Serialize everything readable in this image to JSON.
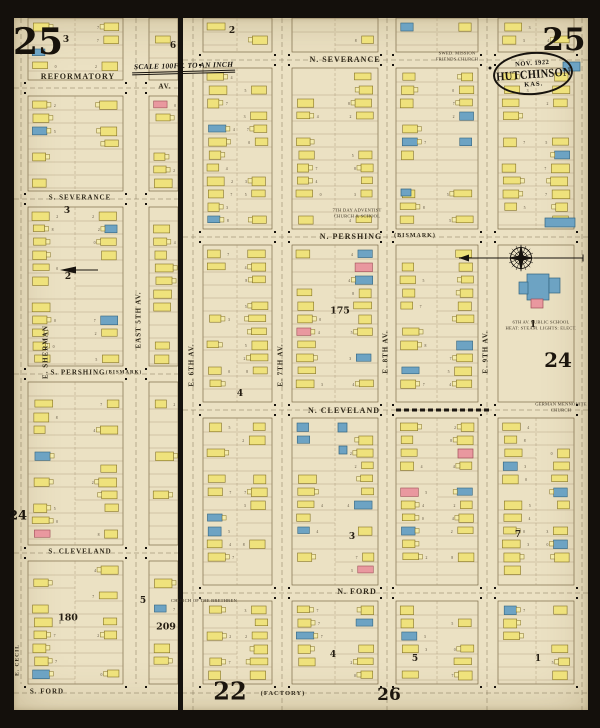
{
  "sheet": {
    "title": "Sanborn Insurance Map - Hutchinson, Kansas - Sheet 25",
    "number_top_left": "25",
    "number_top_right": "25",
    "stamp": {
      "date": "NOV. 1922",
      "city": "HUTCHINSON",
      "state": "KAS."
    },
    "scale_banner": "SCALE 100FT. TO AN INCH",
    "lot_number_glyphs": "2345780"
  },
  "colors": {
    "paper": "#ebe1c3",
    "ink": "#17130e",
    "block-line": "#7c6b48",
    "lot-line": "#a39170",
    "bldg-yellow": "#efe27c",
    "bldg-yellow-stroke": "#857326",
    "bldg-blue": "#6da3c3",
    "bldg-blue-stroke": "#33647f",
    "bldg-pink": "#e9989f",
    "bldg-pink-stroke": "#9e4f58"
  },
  "street_labels": [
    {
      "text": "REFORMATORY",
      "x": 78,
      "y": 77,
      "fs": 8
    },
    {
      "text": "AV.",
      "x": 165,
      "y": 87,
      "fs": 7
    },
    {
      "text": "N. SEVERANCE",
      "x": 345,
      "y": 60,
      "fs": 8
    },
    {
      "text": "S. SEVERANCE",
      "x": 80,
      "y": 198,
      "fs": 7
    },
    {
      "text": "N. PERSHING",
      "x": 351,
      "y": 237,
      "fs": 8
    },
    {
      "text": "(BISMARK)",
      "x": 415,
      "y": 236,
      "fs": 6
    },
    {
      "text": "S. PERSHING",
      "x": 78,
      "y": 373,
      "fs": 7
    },
    {
      "text": "(BISMARK)",
      "x": 124,
      "y": 373,
      "fs": 5
    },
    {
      "text": "N. CLEVELAND",
      "x": 344,
      "y": 411,
      "fs": 8
    },
    {
      "text": "S. CLEVELAND",
      "x": 80,
      "y": 552,
      "fs": 7
    },
    {
      "text": "N. FORD",
      "x": 357,
      "y": 592,
      "fs": 8
    },
    {
      "text": "S. FORD",
      "x": 47,
      "y": 692,
      "fs": 7
    },
    {
      "text": "(FACTORY)",
      "x": 283,
      "y": 694,
      "fs": 6.5
    },
    {
      "text": "E. SHERMAN",
      "x": 46,
      "y": 352,
      "fs": 7,
      "v": true
    },
    {
      "text": "EAST 5TH AV.",
      "x": 139,
      "y": 320,
      "fs": 7,
      "v": true
    },
    {
      "text": "E. 6TH AV.",
      "x": 192,
      "y": 365,
      "fs": 7,
      "v": true
    },
    {
      "text": "E. 7TH AV.",
      "x": 281,
      "y": 365,
      "fs": 7,
      "v": true
    },
    {
      "text": "E. 8TH AV.",
      "x": 386,
      "y": 352,
      "fs": 7,
      "v": true
    },
    {
      "text": "E. 9TH AV.",
      "x": 486,
      "y": 352,
      "fs": 7,
      "v": true
    },
    {
      "text": "E. CECIL",
      "x": 18,
      "y": 660,
      "fs": 5.5,
      "v": true
    }
  ],
  "adjacent_sheet_refs": [
    {
      "t": "24",
      "x": 558,
      "y": 360,
      "fs": 20
    },
    {
      "t": "24",
      "x": 18,
      "y": 516,
      "fs": 13
    },
    {
      "t": "22",
      "x": 230,
      "y": 691,
      "fs": 24
    },
    {
      "t": "26",
      "x": 389,
      "y": 695,
      "fs": 17
    }
  ],
  "block_numbers": [
    {
      "t": "3",
      "x": 66,
      "y": 40
    },
    {
      "t": "6",
      "x": 173,
      "y": 46
    },
    {
      "t": "2",
      "x": 232,
      "y": 31
    },
    {
      "t": "3",
      "x": 67,
      "y": 211
    },
    {
      "t": "2",
      "x": 68,
      "y": 277
    },
    {
      "t": "175",
      "x": 340,
      "y": 311
    },
    {
      "t": "1",
      "x": 533,
      "y": 325
    },
    {
      "t": "4",
      "x": 240,
      "y": 394
    },
    {
      "t": "3",
      "x": 352,
      "y": 537
    },
    {
      "t": "7",
      "x": 518,
      "y": 535
    },
    {
      "t": "180",
      "x": 68,
      "y": 618
    },
    {
      "t": "209",
      "x": 166,
      "y": 627
    },
    {
      "t": "5",
      "x": 143,
      "y": 601
    },
    {
      "t": "4",
      "x": 333,
      "y": 655
    },
    {
      "t": "5",
      "x": 415,
      "y": 659
    },
    {
      "t": "1",
      "x": 538,
      "y": 659
    }
  ],
  "landmarks": [
    {
      "lines": [
        "SWED. MISSION",
        "FRIENDS CHURCH"
      ],
      "x": 457,
      "y": 56
    },
    {
      "lines": [
        "7TH DAY ADVENTIST",
        "CHURCH & SCHOOL"
      ],
      "x": 357,
      "y": 213
    },
    {
      "lines": [
        "6TH AV. PUBLIC SCHOOL",
        "HEAT: STEAM. LIGHTS: ELECT."
      ],
      "x": 541,
      "y": 325
    },
    {
      "lines": [
        "CHURCH OF THE BRETHREN"
      ],
      "x": 204,
      "y": 601
    },
    {
      "lines": [
        "GERMAN MENNONITE",
        "CHURCH"
      ],
      "x": 561,
      "y": 407
    }
  ],
  "map": {
    "corridors_h": [
      {
        "y": 88,
        "x1": 14,
        "x2": 178
      },
      {
        "y": 60,
        "x1": 183,
        "x2": 588
      },
      {
        "y": 199,
        "x1": 14,
        "x2": 178
      },
      {
        "y": 237,
        "x1": 183,
        "x2": 588
      },
      {
        "y": 374,
        "x1": 14,
        "x2": 178
      },
      {
        "y": 410,
        "x1": 183,
        "x2": 588
      },
      {
        "y": 553,
        "x1": 14,
        "x2": 178
      },
      {
        "y": 593,
        "x1": 183,
        "x2": 588
      },
      {
        "y": 693,
        "x1": 14,
        "x2": 588
      }
    ],
    "corridors_v": [
      {
        "x": 21,
        "y1": 18,
        "y2": 684
      },
      {
        "x": 136,
        "y1": 18,
        "y2": 684
      },
      {
        "x": 193,
        "y1": 18,
        "y2": 710
      },
      {
        "x": 282,
        "y1": 18,
        "y2": 710
      },
      {
        "x": 387,
        "y1": 18,
        "y2": 710
      },
      {
        "x": 487,
        "y1": 18,
        "y2": 710
      },
      {
        "x": 582,
        "y1": 18,
        "y2": 710
      }
    ],
    "blocks": [
      {
        "x1": 28,
        "y1": 18,
        "x2": 123,
        "y2": 80,
        "alley": 75
      },
      {
        "x1": 28,
        "y1": 96,
        "x2": 123,
        "y2": 191,
        "alley": 75
      },
      {
        "x1": 28,
        "y1": 207,
        "x2": 123,
        "y2": 366,
        "alley": 75
      },
      {
        "x1": 28,
        "y1": 382,
        "x2": 123,
        "y2": 545,
        "alley": 75
      },
      {
        "x1": 28,
        "y1": 561,
        "x2": 123,
        "y2": 684,
        "alley": 75
      },
      {
        "x1": 149,
        "y1": 18,
        "x2": 178,
        "y2": 80
      },
      {
        "x1": 149,
        "y1": 96,
        "x2": 178,
        "y2": 191
      },
      {
        "x1": 149,
        "y1": 207,
        "x2": 178,
        "y2": 366
      },
      {
        "x1": 149,
        "y1": 382,
        "x2": 178,
        "y2": 545,
        "density": 0.2
      },
      {
        "x1": 149,
        "y1": 561,
        "x2": 178,
        "y2": 684
      },
      {
        "x1": 203,
        "y1": 18,
        "x2": 272,
        "y2": 52,
        "alley": 237
      },
      {
        "x1": 203,
        "y1": 68,
        "x2": 272,
        "y2": 229,
        "alley": 237
      },
      {
        "x1": 203,
        "y1": 245,
        "x2": 272,
        "y2": 402,
        "alley": 237
      },
      {
        "x1": 203,
        "y1": 418,
        "x2": 272,
        "y2": 585,
        "alley": 237
      },
      {
        "x1": 203,
        "y1": 601,
        "x2": 272,
        "y2": 684,
        "alley": 237
      },
      {
        "x1": 292,
        "y1": 18,
        "x2": 378,
        "y2": 52,
        "alley": 335
      },
      {
        "x1": 292,
        "y1": 68,
        "x2": 378,
        "y2": 229,
        "alley": 335
      },
      {
        "x1": 292,
        "y1": 245,
        "x2": 378,
        "y2": 402,
        "alley": 335
      },
      {
        "x1": 292,
        "y1": 418,
        "x2": 378,
        "y2": 585,
        "alley": 335
      },
      {
        "x1": 292,
        "y1": 601,
        "x2": 378,
        "y2": 684,
        "alley": 335
      },
      {
        "x1": 396,
        "y1": 18,
        "x2": 478,
        "y2": 52,
        "alley": 437
      },
      {
        "x1": 396,
        "y1": 68,
        "x2": 478,
        "y2": 229,
        "alley": 437
      },
      {
        "x1": 396,
        "y1": 245,
        "x2": 478,
        "y2": 402,
        "alley": 437
      },
      {
        "x1": 396,
        "y1": 418,
        "x2": 478,
        "y2": 585,
        "alley": 437
      },
      {
        "x1": 396,
        "y1": 601,
        "x2": 478,
        "y2": 684,
        "alley": 437
      },
      {
        "x1": 498,
        "y1": 18,
        "x2": 574,
        "y2": 52,
        "alley": 536
      },
      {
        "x1": 498,
        "y1": 68,
        "x2": 574,
        "y2": 229,
        "alley": 536
      },
      {
        "x1": 498,
        "y1": 245,
        "x2": 574,
        "y2": 402,
        "school": true
      },
      {
        "x1": 498,
        "y1": 418,
        "x2": 574,
        "y2": 585,
        "alley": 536
      },
      {
        "x1": 498,
        "y1": 601,
        "x2": 574,
        "y2": 684,
        "alley": 536
      }
    ],
    "special_buildings": [
      {
        "x": 527,
        "y": 274,
        "w": 22,
        "h": 26,
        "c": "blue",
        "name": "public-school-main"
      },
      {
        "x": 519,
        "y": 282,
        "w": 9,
        "h": 12,
        "c": "blue",
        "name": "public-school-west-wing"
      },
      {
        "x": 549,
        "y": 278,
        "w": 11,
        "h": 15,
        "c": "blue",
        "name": "public-school-east-wing"
      },
      {
        "x": 531,
        "y": 299,
        "w": 12,
        "h": 9,
        "c": "pink",
        "name": "public-school-annex"
      },
      {
        "x": 545,
        "y": 218,
        "w": 30,
        "h": 9,
        "c": "blue",
        "name": "stone-building"
      },
      {
        "x": 563,
        "y": 62,
        "w": 17,
        "h": 9,
        "c": "blue",
        "name": "stone-building"
      },
      {
        "x": 458,
        "y": 449,
        "w": 15,
        "h": 9,
        "c": "pink",
        "name": "brick-building"
      },
      {
        "x": 401,
        "y": 189,
        "w": 10,
        "h": 7,
        "c": "blue",
        "name": "stone-building"
      },
      {
        "x": 338,
        "y": 423,
        "w": 9,
        "h": 9,
        "c": "blue",
        "name": "stone-building"
      },
      {
        "x": 339,
        "y": 446,
        "w": 8,
        "h": 8,
        "c": "blue",
        "name": "stone-building"
      }
    ],
    "compass": {
      "x": 521,
      "y": 258
    },
    "divider": {
      "x": 178,
      "w": 5
    },
    "railway": {
      "y": 410,
      "x1": 396,
      "x2": 487
    },
    "index_arrow": {
      "x": 60,
      "y": 270
    }
  }
}
